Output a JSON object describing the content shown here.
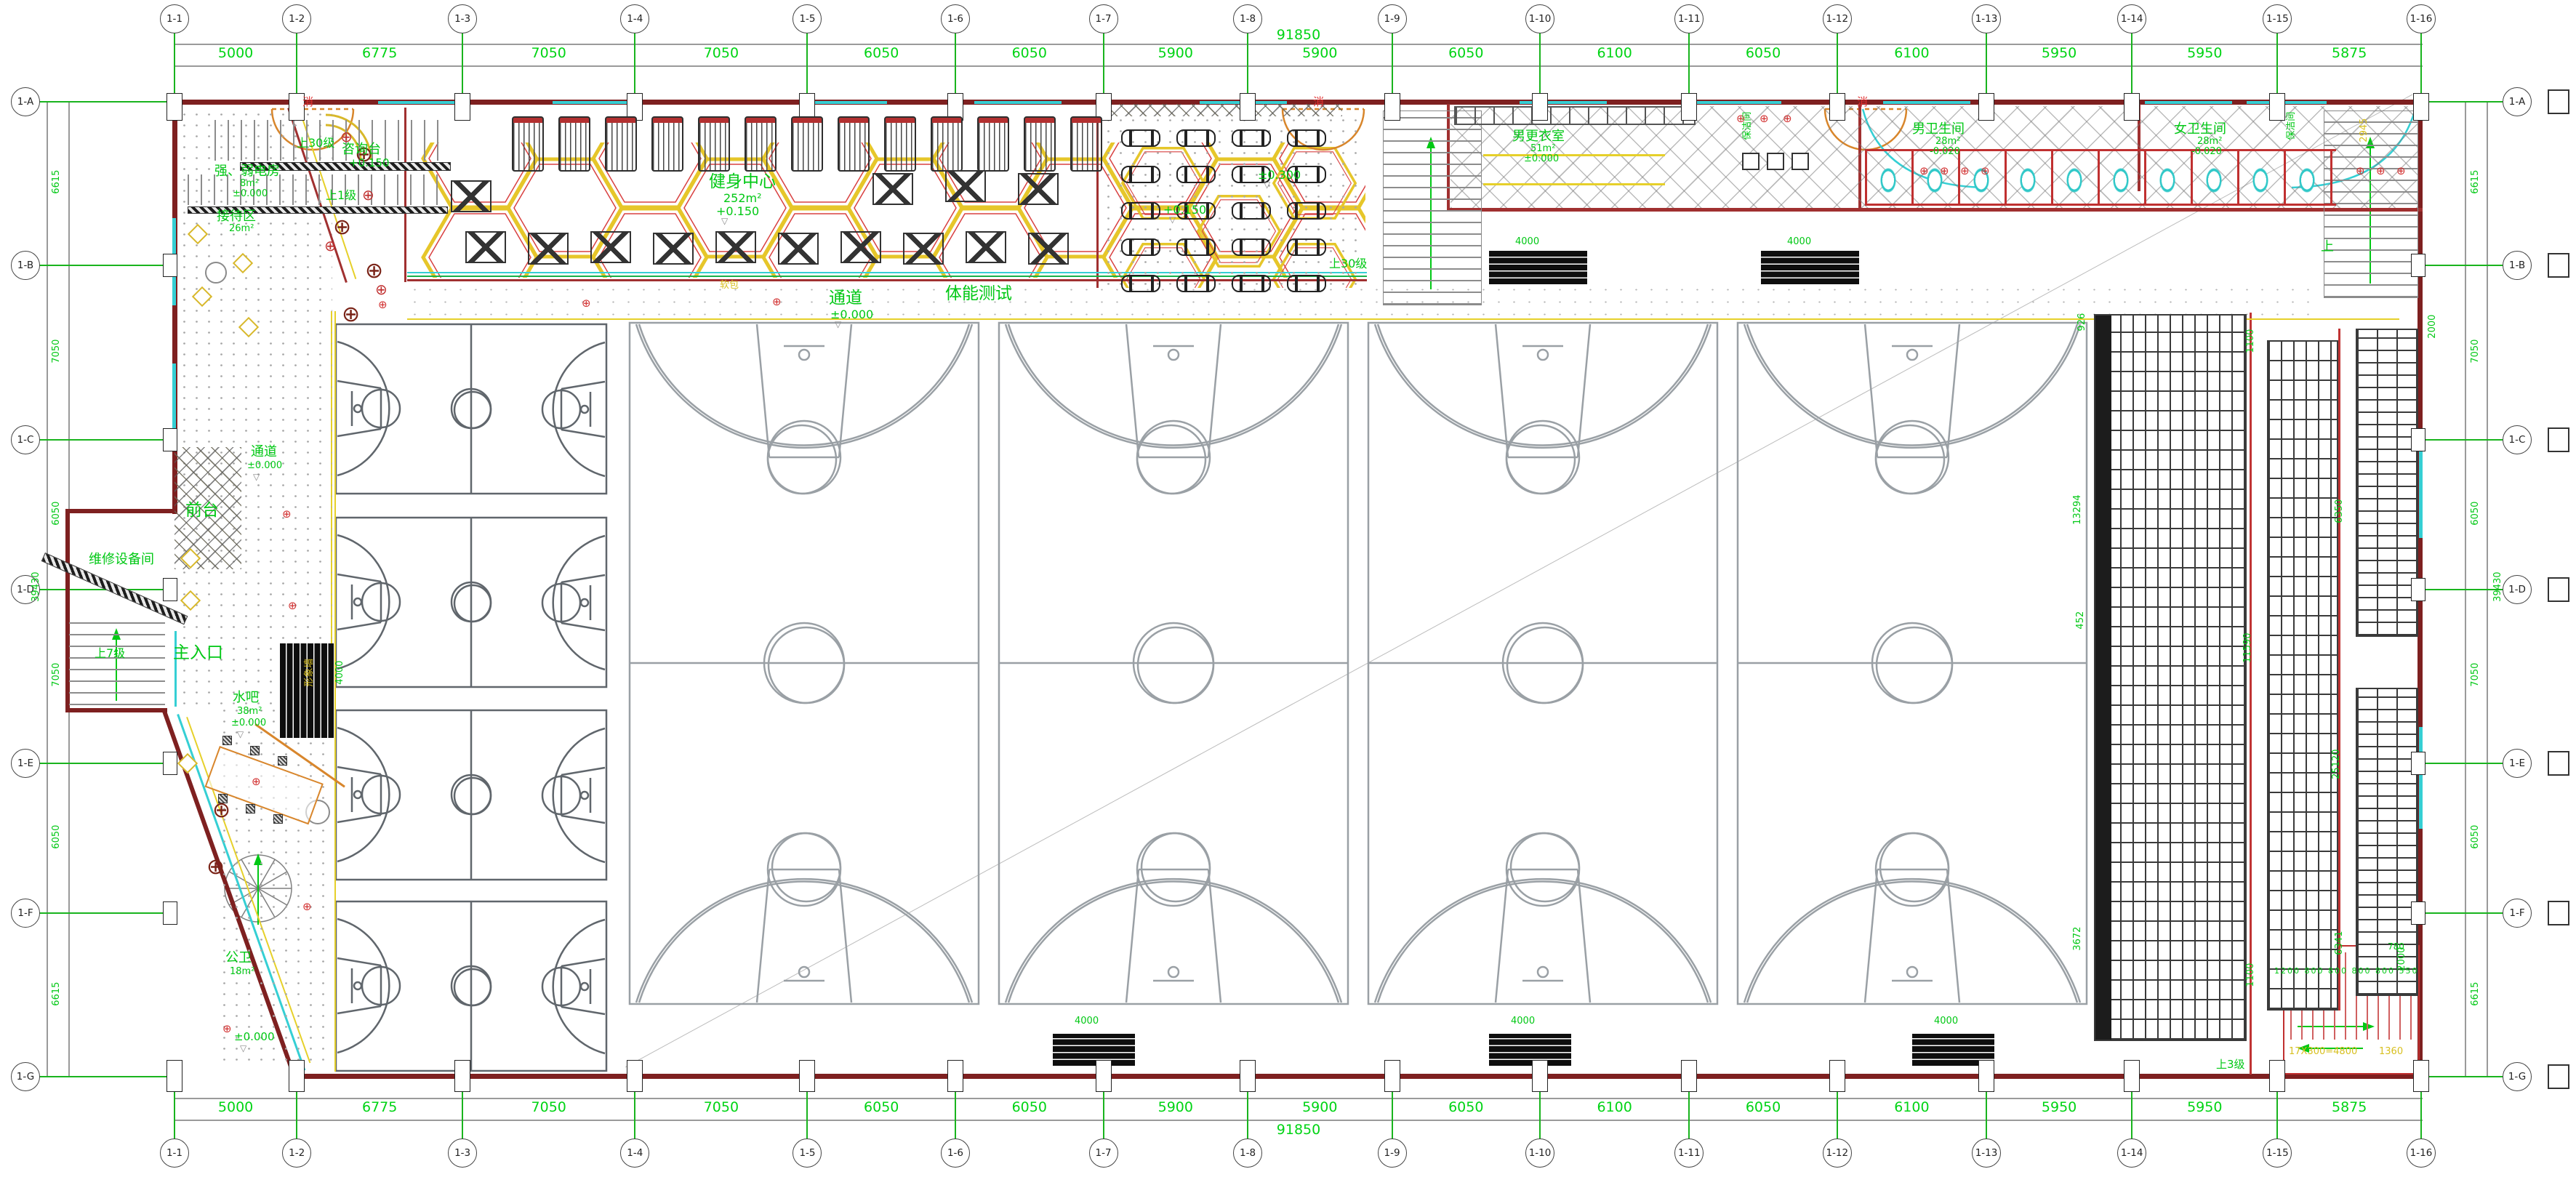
{
  "grid": {
    "cols": {
      "labels": [
        "1-1",
        "1-2",
        "1-3",
        "1-4",
        "1-5",
        "1-6",
        "1-7",
        "1-8",
        "1-9",
        "1-10",
        "1-11",
        "1-12",
        "1-13",
        "1-14",
        "1-15",
        "1-16"
      ],
      "dims": [
        "5000",
        "6775",
        "7050",
        "7050",
        "6050",
        "6050",
        "5900",
        "5900",
        "6050",
        "6100",
        "6050",
        "6100",
        "5950",
        "5950",
        "5875"
      ],
      "total": "91850"
    },
    "rows": {
      "labels": [
        "1-A",
        "1-B",
        "1-C",
        "1-D",
        "1-E",
        "1-F",
        "1-G"
      ],
      "dims": [
        "6615",
        "7050",
        "6050",
        "7050",
        "6050",
        "6615"
      ],
      "total": "39430"
    }
  },
  "rooms": {
    "fitness": {
      "name": "健身中心",
      "area": "252m²",
      "level": "+0.150"
    },
    "fitness_test": {
      "name": "体能测试"
    },
    "corridor_top": {
      "name": "通道",
      "level": "±0.000"
    },
    "corridor_left": {
      "name": "通道",
      "level": "±0.000"
    },
    "info_desk": {
      "name": "咨询台",
      "level": "+0.150"
    },
    "elec_room": {
      "name": "强、弱电房",
      "area": "8m²",
      "level": "±0.000"
    },
    "reception": {
      "name": "接待区",
      "area": "26m²"
    },
    "mens_locker": {
      "name": "男更衣室",
      "area": "51m²",
      "level": "±0.000"
    },
    "mens_wc": {
      "name": "男卫生间",
      "area": "28m²",
      "level": "-0.020"
    },
    "womens_wc": {
      "name": "女卫生间",
      "area": "28m²",
      "level": "-0.020"
    },
    "cleaning": {
      "name": "保洁间"
    },
    "front_desk": {
      "name": "前台"
    },
    "maintenance": {
      "name": "维修设备间"
    },
    "main_entrance": {
      "name": "主入口"
    },
    "water_bar": {
      "name": "水吧",
      "area": "38m²",
      "level": "±0.000"
    },
    "public_wc": {
      "name": "公卫",
      "area": "18m²"
    },
    "image_wall": {
      "name": "形象墙"
    }
  },
  "stairs": {
    "up30_left": "上30级",
    "up30_mid": "上30级",
    "up7": "上7级",
    "up1": "上1级",
    "up3": "上3级",
    "up": "上",
    "run_note": "17X300=4800",
    "run_note2": "1360"
  },
  "levels": {
    "zero": "±0.000",
    "plus150": "+0.150",
    "plus300": "±0.300"
  },
  "symbols": {
    "fire": "消",
    "flower": "⊕",
    "level_mark": "▽"
  },
  "misc": {
    "soft": "软包"
  },
  "dims": {
    "d4000": "4000",
    "d2000": "2000",
    "d1100": "1100",
    "d11590": "11590",
    "d6350": "6350",
    "d25120": "25120",
    "d6341": "6341",
    "d13294": "13294",
    "d452": "452",
    "d926": "926",
    "d3672": "3672",
    "d2945": "2945",
    "d780": "780",
    "row_small": "1200 800 800 800 800 550"
  },
  "colors": {
    "dim_green": "#00d414",
    "wall_red": "#7e2020",
    "window_cyan": "#35cfd4",
    "hex_gold": "#e6c62a",
    "accent_red": "#c03030",
    "stair_yellow": "#d8c020"
  }
}
